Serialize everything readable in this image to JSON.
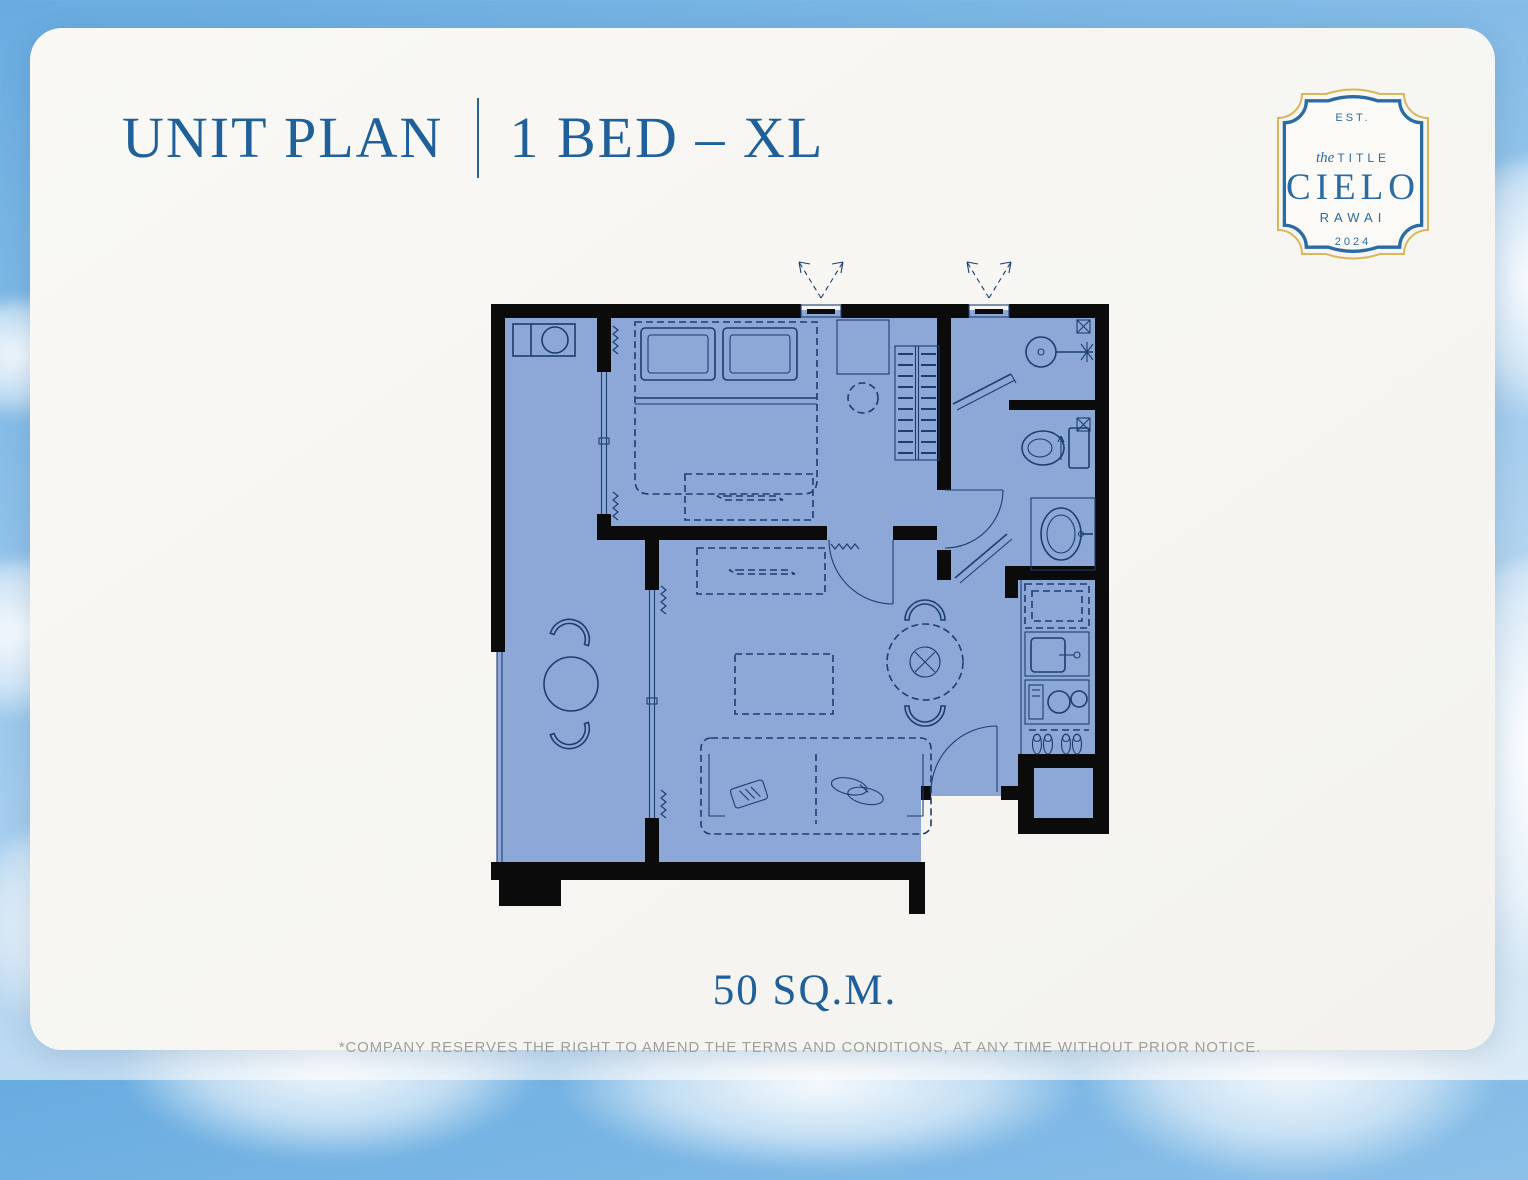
{
  "header": {
    "title": "UNIT PLAN",
    "subtitle": "1 BED – XL"
  },
  "badge": {
    "est_label": "EST.",
    "brand_pre": "the",
    "brand_word": "TITLE",
    "brand_name": "CIELO",
    "location": "RAWAI",
    "year": "2024"
  },
  "floorplan": {
    "area_label": "50 SQ.M.",
    "icons": [
      "air-conditioner-unit",
      "balcony-table",
      "balcony-chair",
      "sliding-door",
      "curtain-squiggle",
      "double-bed",
      "pillow",
      "tv-console",
      "wardrobe",
      "dressing-desk",
      "stool",
      "bedroom-door",
      "shower-head",
      "shower-glass-door",
      "floor-drain",
      "toilet",
      "vanity-sink",
      "bathroom-door",
      "dining-table",
      "dining-chair",
      "refrigerator",
      "kitchen-sink",
      "cooktop",
      "slippers",
      "entrance-door",
      "sofa",
      "coffee-table",
      "window",
      "exhaust-arrows"
    ]
  },
  "footer": {
    "disclaimer": "*COMPANY RESERVES THE RIGHT TO AMEND THE TERMS AND CONDITIONS,  AT ANY TIME WITHOUT PRIOR NOTICE."
  },
  "colors": {
    "accent_blue": "#20609a",
    "badge_blue": "#2b6ba3",
    "badge_gold": "#d9b65c",
    "plan_fill": "#8da8d6",
    "plan_line": "#1c3e70",
    "wall_black": "#0b0b0c",
    "sky_blue": "#85bce7",
    "paper_white": "#f8f7f3",
    "disclaimer_gray": "#9da09b"
  }
}
